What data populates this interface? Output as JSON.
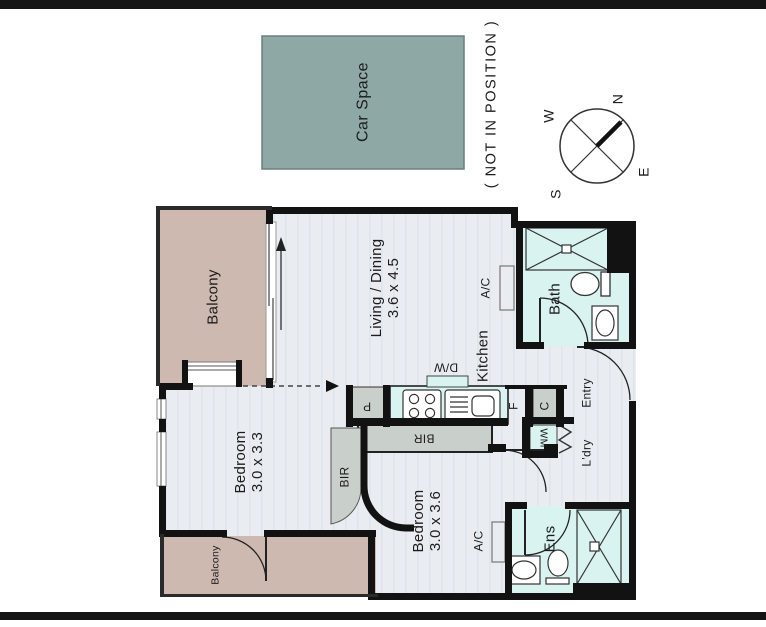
{
  "header": {
    "car_space_label": "Car Space",
    "not_in_position": "( NOT IN POSITION )"
  },
  "compass": {
    "n": "N",
    "e": "E",
    "s": "S",
    "w": "W"
  },
  "rooms": {
    "balcony_main": "Balcony",
    "balcony_small": "Balcony",
    "living": {
      "name": "Living / Dining",
      "dims": "3.6 x 4.5"
    },
    "bedroom1": {
      "name": "Bedroom",
      "dims": "3.0 x 3.3"
    },
    "bedroom2": {
      "name": "Bedroom",
      "dims": "3.0 x 3.6"
    },
    "kitchen": "Kitchen",
    "bath": "Bath",
    "ensuite": "Ens",
    "entry": "Entry",
    "laundry": "L'dry"
  },
  "fixtures": {
    "dishwasher": "D/W",
    "washing_machine": "WM",
    "fridge": "F",
    "cupboard": "C",
    "pantry": "P",
    "built_in_robe": "BIR",
    "air_conditioner": "A/C"
  },
  "colors": {
    "floor": "#e9edf2",
    "floor_stripe": "#dee5ec",
    "balcony": "#cdb9b0",
    "wet": "#d9f3f1",
    "cabinet": "#c9cfca",
    "wall": "#121212",
    "car_space": "#8ea9a5",
    "page_bar": "#151515"
  }
}
